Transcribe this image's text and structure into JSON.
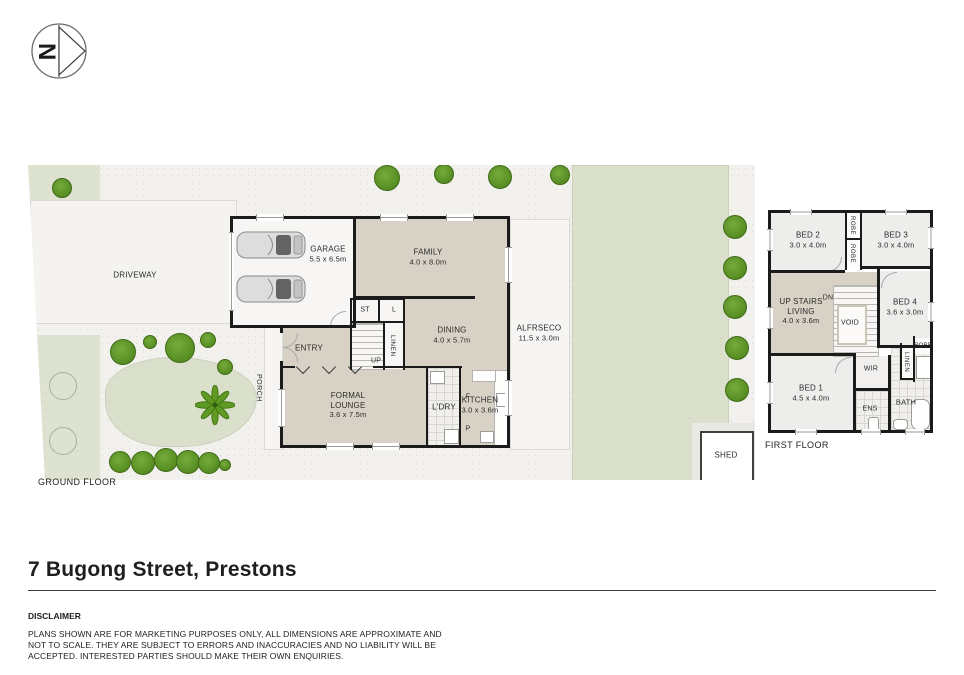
{
  "title": "7 Bugong Street, Prestons",
  "compass": {
    "letter": "N"
  },
  "ground_floor": {
    "label": "GROUND FLOOR",
    "driveway": "DRIVEWAY",
    "porch": "PORCH",
    "shed": "SHED",
    "alfresco": {
      "name": "ALFRSECO",
      "dims": "11.5 x 3.0m"
    },
    "garage": {
      "name": "GARAGE",
      "dims": "5.5 x 6.5m"
    },
    "family": {
      "name": "FAMILY",
      "dims": "4.0 x 8.0m"
    },
    "dining": {
      "name": "DINING",
      "dims": "4.0 x 5.7m"
    },
    "entry": "ENTRY",
    "lounge": {
      "name": "FORMAL LOUNGE",
      "dims": "3.6 x 7.5m"
    },
    "kitchen": {
      "name": "KITCHEN",
      "dims": "3.0 x 3.6m"
    },
    "laundry": "L'DRY",
    "st": "ST",
    "l": "L",
    "linen": "LINEN",
    "up": "UP",
    "fridge": "F",
    "pantry": "P"
  },
  "first_floor": {
    "label": "FIRST FLOOR",
    "bed1": {
      "name": "BED 1",
      "dims": "4.5 x 4.0m"
    },
    "bed2": {
      "name": "BED 2",
      "dims": "3.0 x 4.0m"
    },
    "bed3": {
      "name": "BED 3",
      "dims": "3.0 x 4.0m"
    },
    "bed4": {
      "name": "BED 4",
      "dims": "3.6 x 3.0m"
    },
    "living": {
      "name": "UP STAIRS LIVING",
      "dims": "4.0 x 3.6m"
    },
    "void": "VOID",
    "dn": "DN",
    "wir": "WIR",
    "ens": "ENS",
    "bath": "BATH",
    "robe_top": "ROBE",
    "robe_mid": "ROBE",
    "robe_right": "ROBE",
    "linen": "LINEN"
  },
  "disclaimer": {
    "heading": "DISCLAIMER",
    "lines": [
      "PLANS SHOWN ARE FOR MARKETING PURPOSES ONLY, ALL DIMENSIONS ARE APPROXIMATE AND",
      "NOT TO SCALE. THEY ARE SUBJECT TO ERRORS AND INACCURACIES AND NO LIABILITY WILL BE",
      "ACCEPTED. INTERESTED PARTIES SHOULD MAKE THEIR OWN ENQUIRIES."
    ]
  },
  "colors": {
    "room_fill": "#d8d2c6",
    "bedroom_fill": "#ededeb",
    "lawn": "#dbe0cd",
    "tree": "#5a9125",
    "wall": "#1b1b1b",
    "background": "#ffffff"
  }
}
